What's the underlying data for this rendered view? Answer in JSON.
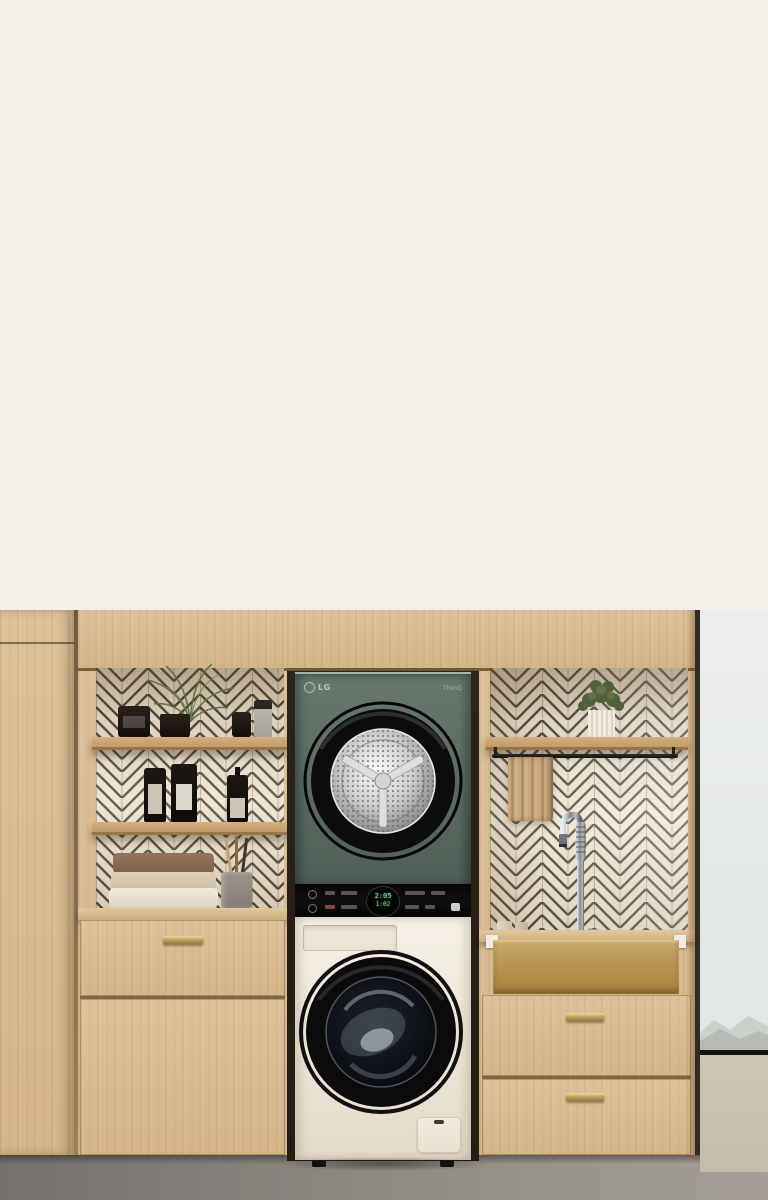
{
  "page": {
    "top_background": "#f4f0e9"
  },
  "appliance": {
    "brand_logo": "LG",
    "thinq_label": "ThinQ",
    "display_top_time": "2:05",
    "display_bottom_time": "1:02"
  },
  "colors": {
    "dryer_green": "#5c6e64",
    "washer_cream": "#f0eadf",
    "cabinet_wood": "#d8bc93",
    "tile_cream": "#ece3d1",
    "grout_brown": "#4e4537",
    "brass_accent": "#b7985f",
    "floor_concrete": "#8d8a84",
    "sky": "#e7ebea",
    "display_digits": "#8df09c"
  }
}
